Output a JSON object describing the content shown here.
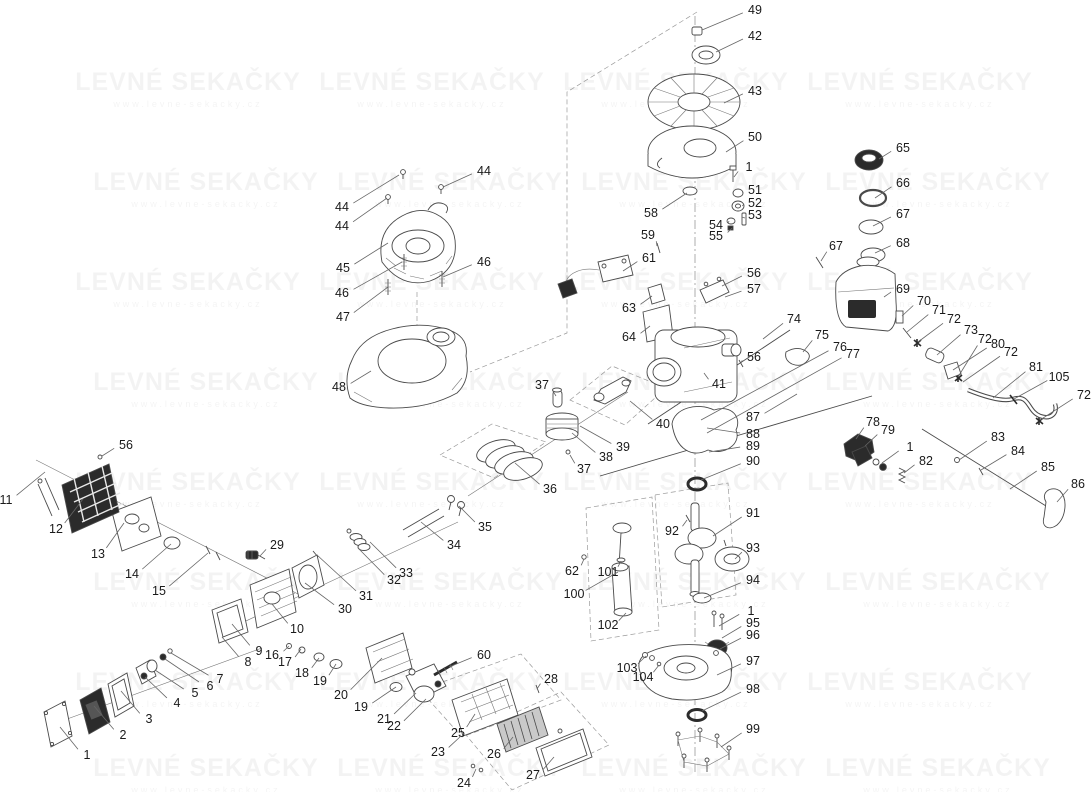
{
  "watermark": {
    "title": "LEVNÉ SEKAČKY",
    "subtitle": "www.levne-sekacky.cz"
  },
  "diagram": {
    "background": "#ffffff",
    "line_color": "#4a4a4a",
    "label_color": "#1a1a1a",
    "leader_color": "#666666",
    "callouts": [
      {
        "n": "49",
        "x": 755,
        "y": 10,
        "tx": 702,
        "ty": 30
      },
      {
        "n": "42",
        "x": 755,
        "y": 36,
        "tx": 716,
        "ty": 52
      },
      {
        "n": "43",
        "x": 755,
        "y": 91,
        "tx": 724,
        "ty": 103
      },
      {
        "n": "50",
        "x": 755,
        "y": 137,
        "tx": 726,
        "ty": 152
      },
      {
        "n": "1",
        "x": 749,
        "y": 167,
        "tx": 734,
        "ty": 177
      },
      {
        "n": "51",
        "x": 755,
        "y": 190,
        "tx": 743,
        "ty": 193
      },
      {
        "n": "52",
        "x": 755,
        "y": 203,
        "tx": 743,
        "ty": 206
      },
      {
        "n": "53",
        "x": 755,
        "y": 215,
        "tx": 745,
        "ty": 218
      },
      {
        "n": "54",
        "x": 716,
        "y": 225,
        "tx": 729,
        "ty": 221
      },
      {
        "n": "55",
        "x": 716,
        "y": 236,
        "tx": 732,
        "ty": 228
      },
      {
        "n": "58",
        "x": 651,
        "y": 213,
        "tx": 687,
        "ty": 193
      },
      {
        "n": "59",
        "x": 648,
        "y": 235,
        "tx": 657,
        "ty": 246
      },
      {
        "n": "61",
        "x": 649,
        "y": 258,
        "tx": 623,
        "ty": 271
      },
      {
        "n": "63",
        "x": 629,
        "y": 308,
        "tx": 652,
        "ty": 296
      },
      {
        "n": "64",
        "x": 629,
        "y": 337,
        "tx": 650,
        "ty": 326
      },
      {
        "n": "56",
        "x": 754,
        "y": 273,
        "tx": 722,
        "ty": 286
      },
      {
        "n": "57",
        "x": 754,
        "y": 289,
        "tx": 725,
        "ty": 297
      },
      {
        "n": "56",
        "x": 754,
        "y": 357,
        "tx": 741,
        "ty": 363
      },
      {
        "n": "41",
        "x": 719,
        "y": 384,
        "tx": 704,
        "ty": 373
      },
      {
        "n": "74",
        "x": 794,
        "y": 319,
        "tx": 763,
        "ty": 339
      },
      {
        "n": "75",
        "x": 822,
        "y": 335,
        "tx": 803,
        "ty": 352
      },
      {
        "n": "76",
        "x": 840,
        "y": 347,
        "tx": 701,
        "ty": 420
      },
      {
        "n": "77",
        "x": 853,
        "y": 354,
        "tx": 707,
        "ty": 433
      },
      {
        "n": "87",
        "x": 753,
        "y": 417,
        "tx": 797,
        "ty": 394
      },
      {
        "n": "88",
        "x": 753,
        "y": 434,
        "tx": 707,
        "ty": 428
      },
      {
        "n": "89",
        "x": 753,
        "y": 446,
        "tx": 709,
        "ty": 452
      },
      {
        "n": "90",
        "x": 753,
        "y": 461,
        "tx": 701,
        "ty": 480
      },
      {
        "n": "65",
        "x": 903,
        "y": 148,
        "tx": 879,
        "ty": 159
      },
      {
        "n": "66",
        "x": 903,
        "y": 183,
        "tx": 875,
        "ty": 198
      },
      {
        "n": "67",
        "x": 903,
        "y": 214,
        "tx": 873,
        "ty": 226
      },
      {
        "n": "68",
        "x": 903,
        "y": 243,
        "tx": 875,
        "ty": 253
      },
      {
        "n": "67",
        "x": 836,
        "y": 246,
        "tx": 821,
        "ty": 261
      },
      {
        "n": "69",
        "x": 903,
        "y": 289,
        "tx": 884,
        "ty": 297
      },
      {
        "n": "70",
        "x": 924,
        "y": 301,
        "tx": 902,
        "ty": 316
      },
      {
        "n": "71",
        "x": 939,
        "y": 310,
        "tx": 907,
        "ty": 332
      },
      {
        "n": "72",
        "x": 954,
        "y": 319,
        "tx": 918,
        "ty": 342
      },
      {
        "n": "73",
        "x": 971,
        "y": 330,
        "tx": 937,
        "ty": 355
      },
      {
        "n": "72",
        "x": 985,
        "y": 339,
        "tx": 958,
        "ty": 377
      },
      {
        "n": "80",
        "x": 998,
        "y": 344,
        "tx": 953,
        "ty": 370
      },
      {
        "n": "72",
        "x": 1011,
        "y": 352,
        "tx": 963,
        "ty": 382
      },
      {
        "n": "81",
        "x": 1036,
        "y": 367,
        "tx": 993,
        "ty": 398
      },
      {
        "n": "105",
        "x": 1059,
        "y": 377,
        "tx": 1014,
        "ty": 399
      },
      {
        "n": "72",
        "x": 1084,
        "y": 395,
        "tx": 1040,
        "ty": 420
      },
      {
        "n": "78",
        "x": 873,
        "y": 422,
        "tx": 856,
        "ty": 439
      },
      {
        "n": "79",
        "x": 888,
        "y": 430,
        "tx": 865,
        "ty": 446
      },
      {
        "n": "1",
        "x": 910,
        "y": 447,
        "tx": 882,
        "ty": 463
      },
      {
        "n": "82",
        "x": 926,
        "y": 461,
        "tx": 904,
        "ty": 473
      },
      {
        "n": "83",
        "x": 998,
        "y": 437,
        "tx": 959,
        "ty": 460
      },
      {
        "n": "84",
        "x": 1018,
        "y": 451,
        "tx": 981,
        "ty": 470
      },
      {
        "n": "85",
        "x": 1048,
        "y": 467,
        "tx": 1010,
        "ty": 489
      },
      {
        "n": "86",
        "x": 1078,
        "y": 484,
        "tx": 1057,
        "ty": 502
      },
      {
        "n": "56",
        "x": 126,
        "y": 445,
        "tx": 102,
        "ty": 456
      },
      {
        "n": "11",
        "x": 6,
        "y": 500,
        "tx": 45,
        "ty": 472
      },
      {
        "n": "12",
        "x": 56,
        "y": 529,
        "tx": 83,
        "ty": 499
      },
      {
        "n": "13",
        "x": 98,
        "y": 554,
        "tx": 124,
        "ty": 523
      },
      {
        "n": "14",
        "x": 132,
        "y": 574,
        "tx": 171,
        "ty": 544
      },
      {
        "n": "15",
        "x": 159,
        "y": 591,
        "tx": 208,
        "ty": 553
      },
      {
        "n": "29",
        "x": 277,
        "y": 545,
        "tx": 260,
        "ty": 556
      },
      {
        "n": "34",
        "x": 454,
        "y": 545,
        "tx": 421,
        "ty": 522
      },
      {
        "n": "33",
        "x": 406,
        "y": 573,
        "tx": 370,
        "ty": 542
      },
      {
        "n": "32",
        "x": 394,
        "y": 580,
        "tx": 358,
        "ty": 548
      },
      {
        "n": "31",
        "x": 366,
        "y": 596,
        "tx": 317,
        "ty": 555
      },
      {
        "n": "30",
        "x": 345,
        "y": 609,
        "tx": 305,
        "ty": 583
      },
      {
        "n": "10",
        "x": 297,
        "y": 629,
        "tx": 272,
        "ty": 604
      },
      {
        "n": "9",
        "x": 259,
        "y": 651,
        "tx": 232,
        "ty": 624
      },
      {
        "n": "16",
        "x": 272,
        "y": 655,
        "tx": 289,
        "ty": 646
      },
      {
        "n": "8",
        "x": 248,
        "y": 662,
        "tx": 222,
        "ty": 637
      },
      {
        "n": "17",
        "x": 285,
        "y": 662,
        "tx": 301,
        "ty": 649
      },
      {
        "n": "18",
        "x": 302,
        "y": 673,
        "tx": 319,
        "ty": 658
      },
      {
        "n": "19",
        "x": 320,
        "y": 681,
        "tx": 336,
        "ty": 664
      },
      {
        "n": "20",
        "x": 341,
        "y": 695,
        "tx": 382,
        "ty": 658
      },
      {
        "n": "19",
        "x": 361,
        "y": 707,
        "tx": 396,
        "ty": 687
      },
      {
        "n": "21",
        "x": 384,
        "y": 719,
        "tx": 416,
        "ty": 693
      },
      {
        "n": "22",
        "x": 394,
        "y": 726,
        "tx": 426,
        "ty": 699
      },
      {
        "n": "60",
        "x": 484,
        "y": 655,
        "tx": 449,
        "ty": 667
      },
      {
        "n": "28",
        "x": 551,
        "y": 679,
        "tx": 537,
        "ty": 689
      },
      {
        "n": "25",
        "x": 458,
        "y": 733,
        "tx": 475,
        "ty": 714
      },
      {
        "n": "23",
        "x": 438,
        "y": 752,
        "tx": 461,
        "ty": 736
      },
      {
        "n": "26",
        "x": 494,
        "y": 754,
        "tx": 513,
        "ty": 737
      },
      {
        "n": "24",
        "x": 464,
        "y": 783,
        "tx": 476,
        "ty": 769
      },
      {
        "n": "27",
        "x": 533,
        "y": 775,
        "tx": 554,
        "ty": 757
      },
      {
        "n": "1",
        "x": 87,
        "y": 755,
        "tx": 60,
        "ty": 727
      },
      {
        "n": "2",
        "x": 123,
        "y": 735,
        "tx": 94,
        "ty": 706
      },
      {
        "n": "3",
        "x": 149,
        "y": 719,
        "tx": 121,
        "ty": 691
      },
      {
        "n": "4",
        "x": 177,
        "y": 703,
        "tx": 145,
        "ty": 677
      },
      {
        "n": "5",
        "x": 195,
        "y": 693,
        "tx": 155,
        "ty": 670
      },
      {
        "n": "6",
        "x": 210,
        "y": 686,
        "tx": 165,
        "ty": 659
      },
      {
        "n": "7",
        "x": 220,
        "y": 679,
        "tx": 171,
        "ty": 653
      },
      {
        "n": "37",
        "x": 542,
        "y": 385,
        "tx": 556,
        "ty": 396
      },
      {
        "n": "40",
        "x": 663,
        "y": 424,
        "tx": 630,
        "ty": 401
      },
      {
        "n": "39",
        "x": 623,
        "y": 447,
        "tx": 580,
        "ty": 426
      },
      {
        "n": "38",
        "x": 606,
        "y": 457,
        "tx": 572,
        "ty": 433
      },
      {
        "n": "37",
        "x": 584,
        "y": 469,
        "tx": 570,
        "ty": 455
      },
      {
        "n": "36",
        "x": 550,
        "y": 489,
        "tx": 515,
        "ty": 463
      },
      {
        "n": "35",
        "x": 485,
        "y": 527,
        "tx": 459,
        "ty": 506
      },
      {
        "n": "44",
        "x": 484,
        "y": 171,
        "tx": 443,
        "ty": 187
      },
      {
        "n": "44",
        "x": 342,
        "y": 207,
        "tx": 399,
        "ty": 175
      },
      {
        "n": "44",
        "x": 342,
        "y": 226,
        "tx": 387,
        "ty": 198
      },
      {
        "n": "45",
        "x": 343,
        "y": 268,
        "tx": 388,
        "ty": 243
      },
      {
        "n": "46",
        "x": 342,
        "y": 293,
        "tx": 402,
        "ty": 262
      },
      {
        "n": "46",
        "x": 484,
        "y": 262,
        "tx": 443,
        "ty": 277
      },
      {
        "n": "47",
        "x": 343,
        "y": 317,
        "tx": 388,
        "ty": 287
      },
      {
        "n": "48",
        "x": 339,
        "y": 387,
        "tx": 371,
        "ty": 371
      },
      {
        "n": "62",
        "x": 572,
        "y": 571,
        "tx": 584,
        "ty": 559
      },
      {
        "n": "101",
        "x": 608,
        "y": 572,
        "tx": 621,
        "ty": 561
      },
      {
        "n": "100",
        "x": 574,
        "y": 594,
        "tx": 618,
        "ty": 572
      },
      {
        "n": "102",
        "x": 608,
        "y": 625,
        "tx": 626,
        "ty": 613
      },
      {
        "n": "92",
        "x": 672,
        "y": 531,
        "tx": 687,
        "ty": 520
      },
      {
        "n": "91",
        "x": 753,
        "y": 513,
        "tx": 713,
        "ty": 536
      },
      {
        "n": "93",
        "x": 753,
        "y": 548,
        "tx": 735,
        "ty": 559
      },
      {
        "n": "94",
        "x": 753,
        "y": 580,
        "tx": 704,
        "ty": 598
      },
      {
        "n": "1",
        "x": 751,
        "y": 611,
        "tx": 719,
        "ty": 626
      },
      {
        "n": "95",
        "x": 753,
        "y": 623,
        "tx": 722,
        "ty": 638
      },
      {
        "n": "96",
        "x": 753,
        "y": 635,
        "tx": 720,
        "ty": 649
      },
      {
        "n": "97",
        "x": 753,
        "y": 661,
        "tx": 717,
        "ty": 675
      },
      {
        "n": "98",
        "x": 753,
        "y": 689,
        "tx": 702,
        "ty": 711
      },
      {
        "n": "99",
        "x": 753,
        "y": 729,
        "tx": 721,
        "ty": 747
      },
      {
        "n": "103",
        "x": 627,
        "y": 668,
        "tx": 646,
        "ty": 656
      },
      {
        "n": "104",
        "x": 643,
        "y": 677,
        "tx": 659,
        "ty": 665
      }
    ]
  }
}
